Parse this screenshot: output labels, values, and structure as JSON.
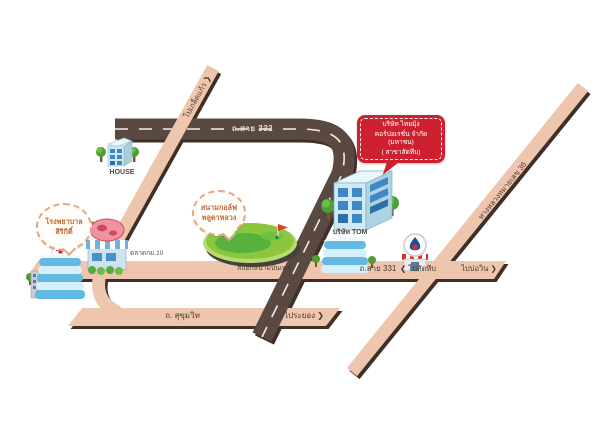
{
  "roads": {
    "route332": "ถ.สาย 332",
    "route331": "ถ.สาย 331",
    "sukhumvit": "ถ. สุขุมวิท",
    "highway36": "ทางหลวงหมายเลข 36",
    "junction": "สี่แยกสนามบินเพล",
    "dir_sattahip": "❮ ไปสัตหีบ",
    "dir_bowin": "ไปบ่อวิน ❯",
    "dir_rayong": "ไประยอง ❯",
    "dir_kledkaew": "ไปเกล็ดแก้ว ❯"
  },
  "places": {
    "house": "HOUSE",
    "hospital_line1": "โรงพยาบาล",
    "hospital_line2": "สิริกิติ์",
    "golf_line1": "สนามกอล์ฟ",
    "golf_line2": "พลูตาหลวง",
    "market": "ตลาดกม.10",
    "tom": "บริษัท TOM"
  },
  "callout": {
    "line1": "บริษัท ไทยมุ้ง",
    "line2": "คอร์ปอเรชั่น จำกัด (มหาชน)",
    "line3": "( สาขาสัตหีบ)"
  },
  "colors": {
    "road_dark": "#594941",
    "road_pink": "#eec6ae",
    "road_shadow": "#3f2f26",
    "callout_red": "#ce2130",
    "badge_text": "#c06a33",
    "golf_green": "#8cc63e"
  }
}
